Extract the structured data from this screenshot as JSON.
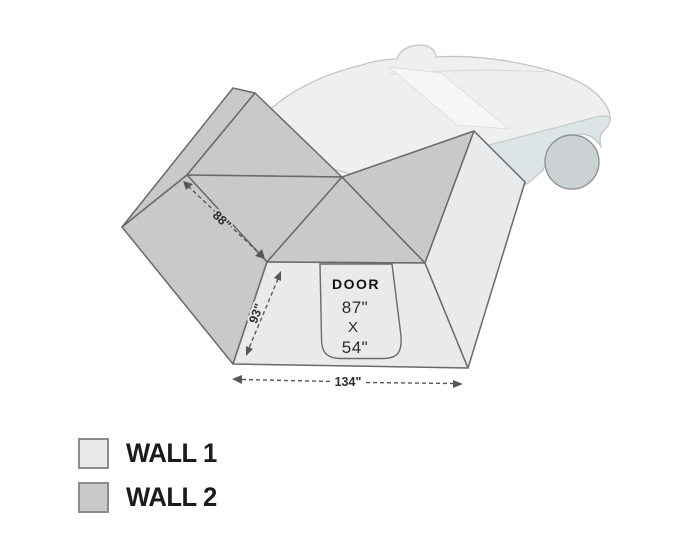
{
  "diagram": {
    "door": {
      "label": "DOOR",
      "height": "87\"",
      "separator": "X",
      "width": "54\""
    },
    "dimensions": {
      "panel_edge": "88\"",
      "front_left_edge": "93\"",
      "front_width": "134\""
    }
  },
  "legend": {
    "items": [
      {
        "label": "WALL 1",
        "color": "#e9eaec"
      },
      {
        "label": "WALL 2",
        "color": "#c8c9cb"
      }
    ]
  },
  "colors": {
    "wall1": "#e9eaec",
    "wall2": "#c8c9cb",
    "outline": "#6a6a6c",
    "dimension": "#57575a",
    "vehicle_body": "#eef0f0",
    "vehicle_accent": "#dde4e5",
    "vehicle_glass": "#f5f7f7",
    "vehicle_outline": "#c2c6c6",
    "wheel": "#ccd2d4"
  }
}
